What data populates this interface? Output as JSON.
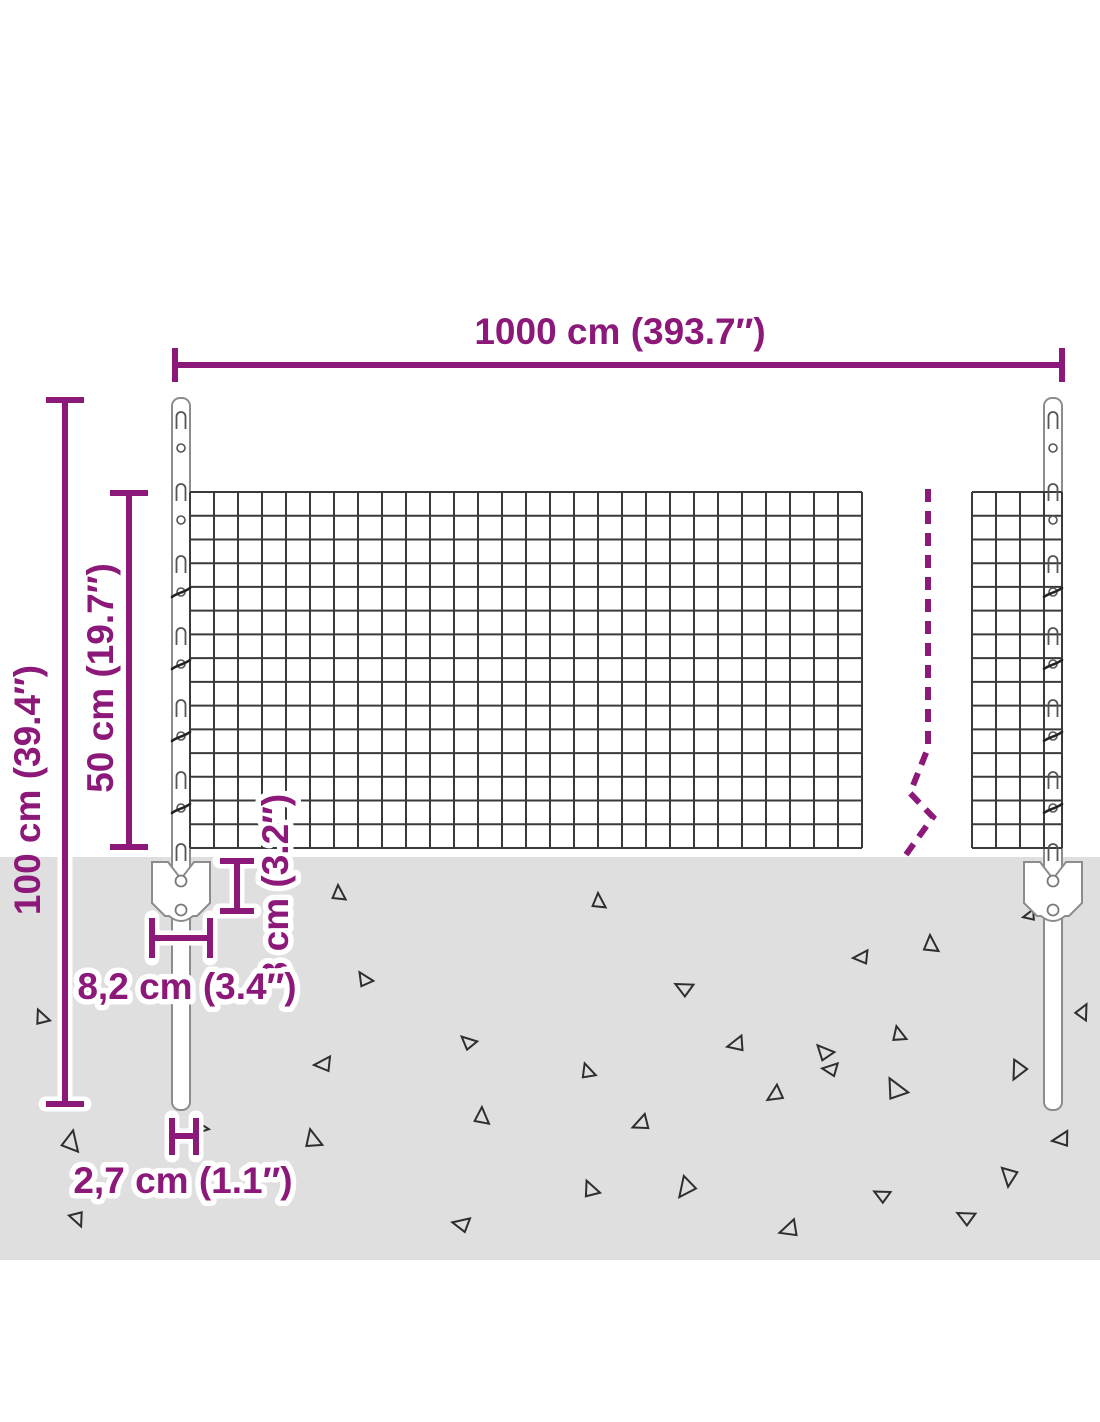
{
  "diagram": {
    "type": "product-dimension-diagram",
    "subject": "wire mesh fence set with steel posts and ground anchors",
    "labels": {
      "total_width": "1000 cm (393.7″)",
      "total_height": "100 cm (39.4″)",
      "mesh_height": "50 cm (19.7″)",
      "anchor_plate_height": "8 cm (3.2″)",
      "anchor_plate_width": "8,2 cm (3.4″)",
      "post_width": "2,7 cm (1.1″)"
    },
    "colors": {
      "accent": "#8C1879",
      "ground": "#E0DFDF",
      "mesh": "#3A3A3A",
      "outline": "#8C8C8C",
      "triangle": "#2E2E2E",
      "background": "#FFFFFF"
    }
  }
}
